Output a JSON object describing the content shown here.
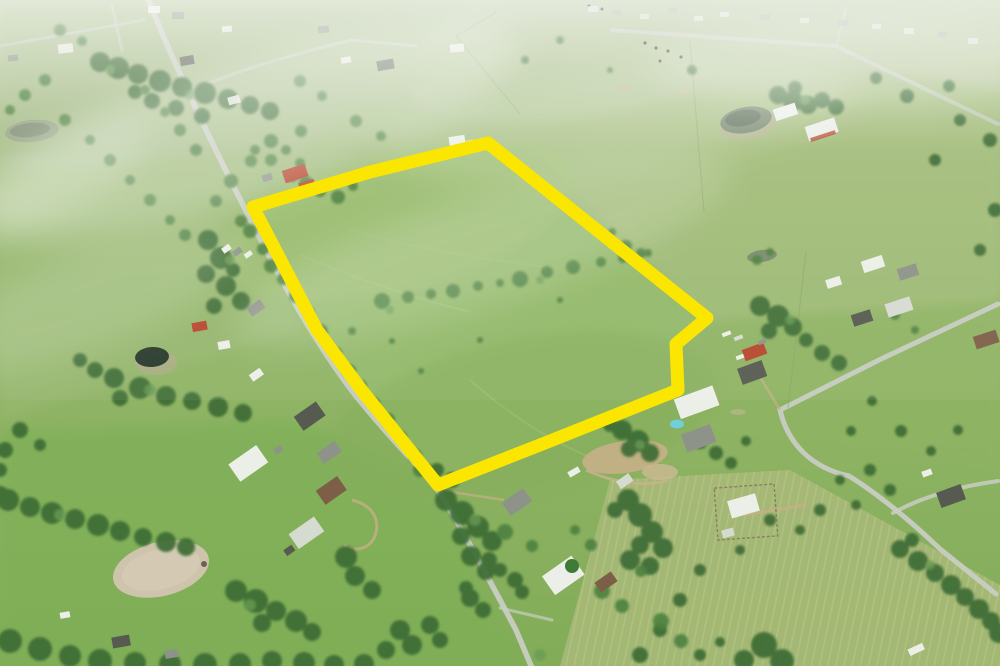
{
  "scene": {
    "type": "aerial-photograph",
    "subject": "drone aerial photo of rural acreage with a highlighted property boundary",
    "text_present": false
  },
  "boundary": {
    "points": "253,207 370,172 488,143 707,318 676,344 678,390 545,443 438,485 363,392 317,330",
    "color": "#FAE600",
    "stroke_width": 13
  },
  "palette": {
    "field_base": "#90B365",
    "field_pale": "#B5C599",
    "field_olive": "#A9BA79",
    "field_bright": "#7EAE56",
    "field_light_patch": "#A4C479",
    "tree_dark": "#3E6C35",
    "tree_mid": "#4E8140",
    "tree_light": "#699B52",
    "road": "#C8CEC3",
    "dirt": "#CEC4AC",
    "dirt_tan": "#C6AF85",
    "pond_dark": "#283A2C",
    "pond_gray": "#75866B",
    "pond_haze": "#97A489",
    "roof_white": "#ECEFE8",
    "roof_gray": "#8E938A",
    "roof_dark": "#565A50",
    "roof_red": "#B8472F",
    "roof_brown": "#7D5F47",
    "metal_light": "#D6DBD2",
    "pool_blue": "#6FD0DC",
    "haze": "#FFFFFF",
    "cattle": "#3A3F35",
    "fence": "#7FA35F"
  },
  "features": {
    "items": [
      {
        "name": "property-boundary",
        "center": [
          470,
          310
        ]
      },
      {
        "name": "main-road-diagonal",
        "center": [
          340,
          330
        ]
      },
      {
        "name": "right-neighborhood-road",
        "center": [
          885,
          440
        ]
      },
      {
        "name": "top-right-road",
        "center": [
          900,
          80
        ]
      },
      {
        "name": "riding-arena-dirt-oval",
        "center": [
          161,
          569
        ]
      },
      {
        "name": "dark-pond",
        "center": [
          152,
          357
        ]
      },
      {
        "name": "hazy-pond-top-left",
        "center": [
          32,
          131
        ]
      },
      {
        "name": "pond-top-right",
        "center": [
          746,
          120
        ]
      },
      {
        "name": "small-pond-right",
        "center": [
          762,
          256
        ]
      },
      {
        "name": "red-roof-houses",
        "center": [
          293,
          176
        ]
      },
      {
        "name": "white-barn-bottom-left",
        "center": [
          248,
          463
        ]
      },
      {
        "name": "metal-barn-bottom-left",
        "center": [
          306,
          533
        ]
      },
      {
        "name": "fenced-homestead",
        "center": [
          746,
          512
        ]
      },
      {
        "name": "swimming-pool",
        "center": [
          677,
          424
        ]
      },
      {
        "name": "red-barn-right",
        "center": [
          754,
          352
        ]
      },
      {
        "name": "white-metal-building-right",
        "center": [
          696,
          402
        ]
      },
      {
        "name": "dirt-patch-bottom-center",
        "center": [
          625,
          457
        ]
      },
      {
        "name": "mowed-olive-field-bottom-right",
        "center": [
          820,
          570
        ]
      },
      {
        "name": "hedgerow-southeast",
        "center": [
          950,
          585
        ]
      },
      {
        "name": "cattle-dots",
        "center": [
          660,
          50
        ]
      },
      {
        "name": "residential-cluster-top-left",
        "center": [
          180,
          80
        ]
      },
      {
        "name": "houses-bottom-center",
        "center": [
          560,
          560
        ]
      },
      {
        "name": "rv-trailer",
        "center": [
          916,
          649
        ]
      },
      {
        "name": "haze-clouds",
        "center": [
          400,
          150
        ]
      }
    ]
  }
}
